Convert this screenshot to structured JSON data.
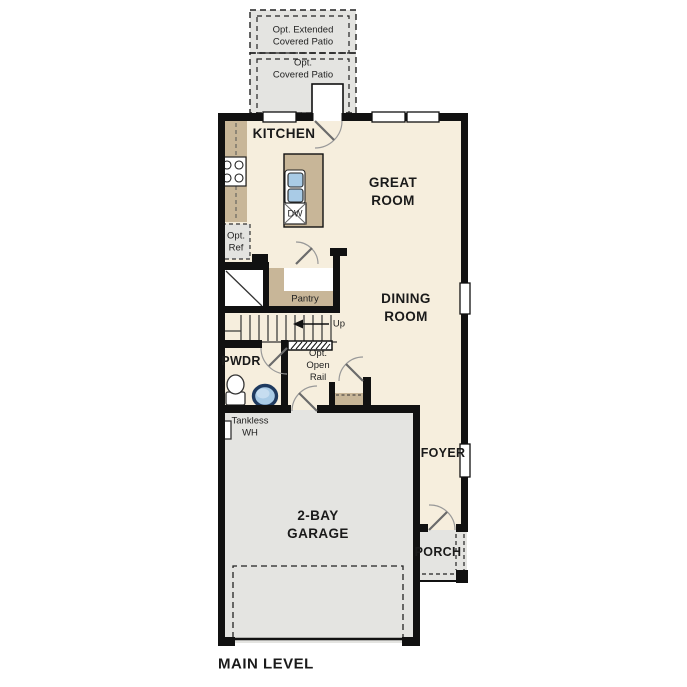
{
  "plan": {
    "title": "MAIN LEVEL",
    "rooms": {
      "kitchen": "KITCHEN",
      "great_room": "GREAT\nROOM",
      "dining_room": "DINING\nROOM",
      "pwdr": "PWDR",
      "foyer": "FOYER",
      "garage": "2-BAY\nGARAGE",
      "porch": "PORCH",
      "pantry": "Pantry"
    },
    "options": {
      "extended_patio": "Opt. Extended\nCovered Patio",
      "covered_patio": "Opt.\nCovered Patio",
      "refrigerator": "Opt.\nRef",
      "open_rail": "Opt.\nOpen\nRail"
    },
    "annotations": {
      "up": "Up",
      "dishwasher": "DW",
      "tankless": "Tankless\nWH"
    },
    "colors": {
      "wall": "#111111",
      "floor": "#f6eedd",
      "concrete": "#e4e4e1",
      "cabinet": "#c8b698",
      "fixture_blue": "#a9cbe6",
      "fixture_ring": "#1f3a5f"
    }
  }
}
